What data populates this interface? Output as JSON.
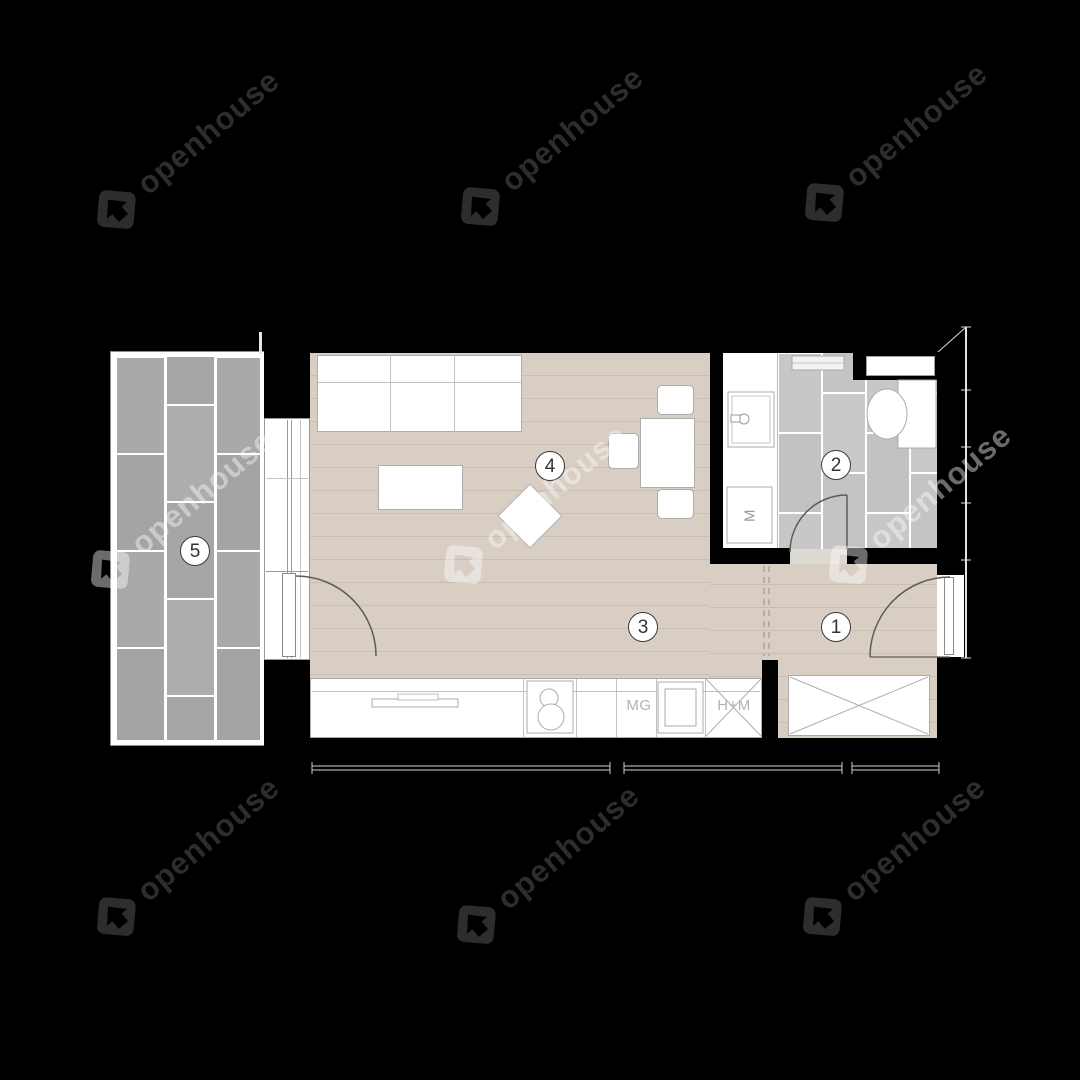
{
  "watermark": {
    "text": "openhouse",
    "dark_color": "#2d2d2d",
    "light_color": "rgba(255,255,255,0.42)"
  },
  "rooms": {
    "entry": {
      "number": "1"
    },
    "bathroom": {
      "number": "2"
    },
    "hall": {
      "number": "3"
    },
    "living": {
      "number": "4"
    },
    "terrace": {
      "number": "5"
    }
  },
  "labels": {
    "dishwasher": "MG",
    "fridge_freezer": "H+M",
    "washing_machine": "M"
  },
  "colors": {
    "background": "#000000",
    "wall": "#000000",
    "wood_floor": "#d8cec3",
    "terrace_tile": "#a9a9a9",
    "bathroom_tile": "#c7c7c7",
    "furniture_outline": "#adadad"
  }
}
